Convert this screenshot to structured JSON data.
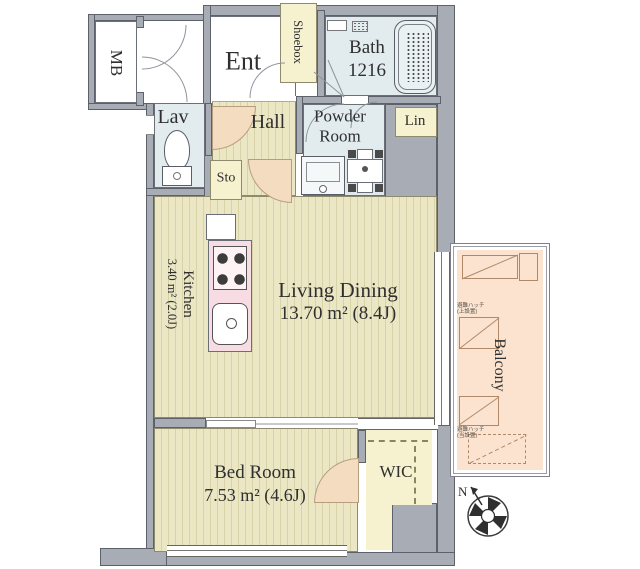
{
  "plan_title": "apartment-floor-plan",
  "rooms": {
    "mb": {
      "label": "MB"
    },
    "ent": {
      "label": "Ent"
    },
    "shoebox": {
      "label": "Shoebox"
    },
    "bath": {
      "label": "Bath",
      "size": "1216"
    },
    "lav": {
      "label": "Lav"
    },
    "hall": {
      "label": "Hall"
    },
    "sto": {
      "label": "Sto"
    },
    "powder": {
      "line1": "Powder",
      "line2": "Room"
    },
    "lin": {
      "label": "Lin"
    },
    "kitchen": {
      "label": "Kitchen",
      "area": "3.40 m² (2.0J)"
    },
    "living": {
      "label": "Living Dining",
      "area": "13.70 m² (8.4J)"
    },
    "bed": {
      "label": "Bed Room",
      "area": "7.53 m² (4.6J)"
    },
    "wic": {
      "label": "WIC"
    },
    "balcony": {
      "label": "Balcony",
      "hatch_upper_line1": "避難ハッチ",
      "hatch_upper_line2": "(上設置)",
      "hatch_lower_line1": "避難ハッチ",
      "hatch_lower_line2": "(当設置)"
    }
  },
  "compass": {
    "north": "N"
  },
  "colors": {
    "wall": "#a8acb4",
    "flooring": "#ebe7c5",
    "wet_room": "#e2ecef",
    "closet": "#f6f2cf",
    "balcony": "#fbe3d0",
    "kitchen_counter": "#f7dde3",
    "door_swing": "#f3dcc0"
  }
}
